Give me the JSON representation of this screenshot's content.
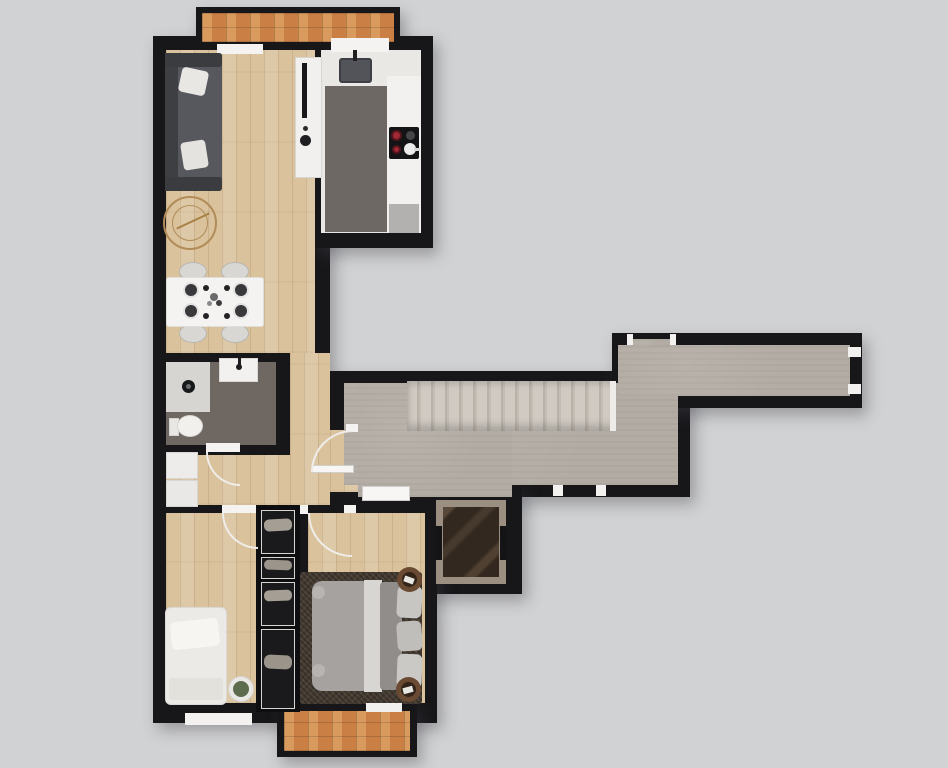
{
  "meta": {
    "label": "apartment-floor-plan",
    "canvas_width": 948,
    "canvas_height": 768
  },
  "palette": {
    "background": "#d1d2d3",
    "walls": "#17171a",
    "wood_floor": "#d9c29c",
    "stone_floor": "#b3aca4",
    "balcony_tile": "#ca8044",
    "white_fixture": "#f2f1ef",
    "kitchen_rug": "#6d6864",
    "bathroom_floor": "#6f6761",
    "bedroom_rug": "#473d33",
    "sofa": "#56585d",
    "burner_accent": "#a12834",
    "elevator_marble": "#32281f"
  },
  "shapes": [
    {
      "n": "balcony-top-frame",
      "c": "blk",
      "x": 196,
      "y": 7,
      "w": 204,
      "h": 40
    },
    {
      "n": "wall-left-wing",
      "c": "blk",
      "x": 153,
      "y": 36,
      "w": 177,
      "h": 687
    },
    {
      "n": "wall-kitchen-wing",
      "c": "blk",
      "x": 313,
      "y": 36,
      "w": 120,
      "h": 212
    },
    {
      "n": "wall-corridor-lower",
      "c": "blk",
      "x": 330,
      "y": 371,
      "w": 360,
      "h": 126
    },
    {
      "n": "wall-corridor-upper",
      "c": "blk",
      "x": 612,
      "y": 333,
      "w": 250,
      "h": 75
    },
    {
      "n": "wall-elevator",
      "c": "blk",
      "x": 420,
      "y": 486,
      "w": 102,
      "h": 108
    },
    {
      "n": "wall-bedrooms-wing",
      "c": "blk",
      "x": 300,
      "y": 495,
      "w": 137,
      "h": 228
    },
    {
      "n": "balcony-bottom-frame",
      "c": "blk",
      "x": 277,
      "y": 704,
      "w": 140,
      "h": 53
    },
    {
      "n": "balcony-top-floor",
      "c": "tile",
      "x": 202,
      "y": 13,
      "w": 192,
      "h": 29
    },
    {
      "n": "living-floor",
      "c": "wood",
      "x": 166,
      "y": 50,
      "w": 149,
      "h": 303
    },
    {
      "n": "hall-floor-right",
      "c": "wood",
      "x": 290,
      "y": 353,
      "w": 40,
      "h": 152
    },
    {
      "n": "hall-floor-lower",
      "c": "wood",
      "x": 166,
      "y": 455,
      "w": 124,
      "h": 50
    },
    {
      "n": "entry-doorway-floor",
      "c": "wood",
      "x": 330,
      "y": 430,
      "w": 28,
      "h": 62
    },
    {
      "n": "bathroom-floor",
      "f": "#6f6761",
      "x": 166,
      "y": 362,
      "w": 110,
      "h": 83
    },
    {
      "n": "corridor-floor-main",
      "c": "stone",
      "x": 344,
      "y": 383,
      "w": 334,
      "h": 102
    },
    {
      "n": "corridor-floor-lobby",
      "c": "stone",
      "x": 358,
      "y": 383,
      "w": 154,
      "h": 114
    },
    {
      "n": "corridor-floor-east",
      "c": "stone",
      "x": 618,
      "y": 345,
      "w": 232,
      "h": 51
    },
    {
      "n": "corridor-door-recess-floor",
      "c": "stone",
      "x": 632,
      "y": 339,
      "w": 38,
      "h": 8
    },
    {
      "n": "bedroom-left-floor",
      "c": "wood",
      "x": 166,
      "y": 513,
      "w": 92,
      "h": 190
    },
    {
      "n": "bedroom-right-floor",
      "c": "wood",
      "x": 308,
      "y": 513,
      "w": 117,
      "h": 190
    },
    {
      "n": "balcony-bottom-floor",
      "c": "tile",
      "x": 284,
      "y": 711,
      "w": 126,
      "h": 40
    },
    {
      "n": "staircase",
      "c": "stairs",
      "x": 407,
      "y": 381,
      "w": 209,
      "h": 50
    },
    {
      "n": "staircase-top-tread",
      "f": "#edece9",
      "x": 610,
      "y": 381,
      "w": 6,
      "h": 50
    },
    {
      "n": "kitchen-floor",
      "f": "#e9e8e5",
      "x": 321,
      "y": 50,
      "w": 100,
      "h": 183
    },
    {
      "n": "kitchen-window-sill",
      "f": "#f4f3f1",
      "x": 331,
      "y": 38,
      "w": 58,
      "h": 14
    },
    {
      "n": "living-window-sill",
      "f": "#f4f3f1",
      "x": 217,
      "y": 44,
      "w": 46,
      "h": 10
    },
    {
      "n": "kitchen-island",
      "f": "#f1f0ee",
      "bd": "1px solid #d8d6d2",
      "x": 295,
      "y": 57,
      "w": 27,
      "h": 121
    },
    {
      "n": "tv-unit",
      "f": "#18181b",
      "x": 302,
      "y": 63,
      "w": 5,
      "h": 55
    },
    {
      "n": "island-decor-small",
      "f": "#2b2b2e",
      "br": "50%",
      "x": 303,
      "y": 126,
      "w": 5,
      "h": 5
    },
    {
      "n": "island-decor-bowl",
      "f": "#1f1f22",
      "br": "50%",
      "x": 300,
      "y": 135,
      "w": 11,
      "h": 11
    },
    {
      "n": "kitchen-rug",
      "f": "#6d6864",
      "x": 325,
      "y": 86,
      "w": 62,
      "h": 146
    },
    {
      "n": "kitchen-counter-right",
      "f": "#f2f1ef",
      "x": 387,
      "y": 76,
      "w": 34,
      "h": 157
    },
    {
      "n": "kitchen-sink",
      "f": "#53545a",
      "bd": "2px solid #3e3f44",
      "br": "3px",
      "x": 339,
      "y": 58,
      "w": 33,
      "h": 25
    },
    {
      "n": "kitchen-faucet",
      "f": "#202022",
      "x": 353,
      "y": 50,
      "w": 4,
      "h": 11
    },
    {
      "n": "cooktop",
      "f": "#141416",
      "br": "2px",
      "x": 389,
      "y": 127,
      "w": 30,
      "h": 32
    },
    {
      "n": "burner-large",
      "f": "#a12834",
      "bd": "2px solid #55141c",
      "br": "50%",
      "x": 391,
      "y": 130,
      "w": 11,
      "h": 11
    },
    {
      "n": "burner-gray",
      "f": "#46464a",
      "br": "50%",
      "x": 406,
      "y": 131,
      "w": 9,
      "h": 9
    },
    {
      "n": "burner-small",
      "f": "#a12834",
      "bd": "2px solid #55141c",
      "br": "50%",
      "x": 392,
      "y": 145,
      "w": 9,
      "h": 9
    },
    {
      "n": "pan",
      "f": "#ececec",
      "br": "50%",
      "x": 404,
      "y": 143,
      "w": 12,
      "h": 12
    },
    {
      "n": "pan-handle",
      "f": "#d8d8d8",
      "x": 414,
      "y": 148,
      "w": 6,
      "h": 3
    },
    {
      "n": "kitchen-end-unit",
      "f": "#b2b1af",
      "x": 389,
      "y": 204,
      "w": 30,
      "h": 29
    },
    {
      "n": "sofa-base",
      "f": "#45474b",
      "br": "3px",
      "x": 165,
      "y": 53,
      "w": 57,
      "h": 138
    },
    {
      "n": "sofa-back",
      "f": "#3d3f43",
      "x": 165,
      "y": 53,
      "w": 13,
      "h": 138
    },
    {
      "n": "sofa-seat",
      "f": "#56585d",
      "x": 178,
      "y": 64,
      "w": 44,
      "h": 116
    },
    {
      "n": "sofa-armrest-top",
      "f": "#3a3c40",
      "br": "3px",
      "x": 165,
      "y": 53,
      "w": 57,
      "h": 14
    },
    {
      "n": "sofa-armrest-bottom",
      "f": "#3a3c40",
      "br": "3px",
      "x": 165,
      "y": 177,
      "w": 57,
      "h": 14
    },
    {
      "n": "sofa-pillow-1",
      "f": "#e9e7e3",
      "br": "4px",
      "rot": 12,
      "x": 180,
      "y": 69,
      "w": 27,
      "h": 25
    },
    {
      "n": "sofa-pillow-2",
      "f": "#e5e3df",
      "br": "4px",
      "rot": -9,
      "x": 182,
      "y": 141,
      "w": 25,
      "h": 28
    },
    {
      "n": "round-rug-outer",
      "bd": "2px solid #b18c58",
      "br": "50%",
      "x": 163,
      "y": 196,
      "w": 54,
      "h": 54
    },
    {
      "n": "round-rug-inner",
      "bd": "1px solid #b18c58",
      "br": "50%",
      "x": 172,
      "y": 205,
      "w": 36,
      "h": 36
    },
    {
      "n": "rug-sprig",
      "f": "#a98045",
      "rot": -25,
      "x": 175,
      "y": 220,
      "w": 36,
      "h": 2
    },
    {
      "n": "dining-chair-1",
      "f": "#d9d7d3",
      "bd": "1px solid #b8b6b2",
      "br": "50%",
      "x": 179,
      "y": 262,
      "w": 28,
      "h": 19
    },
    {
      "n": "dining-chair-2",
      "f": "#d9d7d3",
      "bd": "1px solid #b8b6b2",
      "br": "50%",
      "x": 221,
      "y": 262,
      "w": 28,
      "h": 19
    },
    {
      "n": "dining-chair-3",
      "f": "#d9d7d3",
      "bd": "1px solid #b8b6b2",
      "br": "50%",
      "x": 179,
      "y": 324,
      "w": 28,
      "h": 19
    },
    {
      "n": "dining-chair-4",
      "f": "#d9d7d3",
      "bd": "1px solid #b8b6b2",
      "br": "50%",
      "x": 221,
      "y": 324,
      "w": 28,
      "h": 19
    },
    {
      "n": "dining-table",
      "f": "#f4f3f1",
      "bd": "1px solid #e0dedb",
      "br": "3px",
      "x": 166,
      "y": 277,
      "w": 98,
      "h": 50
    },
    {
      "n": "plate-1",
      "f": "#39393c",
      "bd": "2px solid #e4e3e1",
      "br": "50%",
      "x": 183,
      "y": 282,
      "w": 16,
      "h": 16
    },
    {
      "n": "plate-2",
      "f": "#39393c",
      "bd": "2px solid #e4e3e1",
      "br": "50%",
      "x": 183,
      "y": 303,
      "w": 16,
      "h": 16
    },
    {
      "n": "plate-3",
      "f": "#39393c",
      "bd": "2px solid #e4e3e1",
      "br": "50%",
      "x": 233,
      "y": 282,
      "w": 16,
      "h": 16
    },
    {
      "n": "plate-4",
      "f": "#39393c",
      "bd": "2px solid #e4e3e1",
      "br": "50%",
      "x": 233,
      "y": 303,
      "w": 16,
      "h": 16
    },
    {
      "n": "cup-1",
      "f": "#232325",
      "br": "50%",
      "x": 203,
      "y": 285,
      "w": 6,
      "h": 6
    },
    {
      "n": "cup-2",
      "f": "#232325",
      "br": "50%",
      "x": 203,
      "y": 313,
      "w": 6,
      "h": 6
    },
    {
      "n": "cup-3",
      "f": "#232325",
      "br": "50%",
      "x": 224,
      "y": 285,
      "w": 6,
      "h": 6
    },
    {
      "n": "cup-4",
      "f": "#232325",
      "br": "50%",
      "x": 224,
      "y": 313,
      "w": 6,
      "h": 6
    },
    {
      "n": "centerpiece-1",
      "f": "#6b6b6e",
      "br": "50%",
      "x": 210,
      "y": 293,
      "w": 8,
      "h": 8
    },
    {
      "n": "centerpiece-2",
      "f": "#3d3d40",
      "br": "50%",
      "x": 216,
      "y": 300,
      "w": 6,
      "h": 6
    },
    {
      "n": "centerpiece-3",
      "f": "#8a8a8d",
      "br": "50%",
      "x": 207,
      "y": 301,
      "w": 5,
      "h": 5
    },
    {
      "n": "shower-tray",
      "f": "#d7d5d2",
      "x": 166,
      "y": 362,
      "w": 44,
      "h": 50
    },
    {
      "n": "shower-drain",
      "f": "#17181a",
      "br": "50%",
      "x": 182,
      "y": 380,
      "w": 13,
      "h": 13
    },
    {
      "n": "shower-drain-cap",
      "f": "#6a6a6e",
      "br": "50%",
      "x": 186,
      "y": 384,
      "w": 5,
      "h": 5
    },
    {
      "n": "bathroom-vanity",
      "f": "#f2f1ef",
      "bd": "1px solid #dbd9d6",
      "x": 219,
      "y": 358,
      "w": 39,
      "h": 24
    },
    {
      "n": "vanity-faucet",
      "f": "#1d1d1f",
      "br": "50%",
      "x": 236,
      "y": 364,
      "w": 6,
      "h": 6
    },
    {
      "n": "vanity-faucet-stem",
      "f": "#1d1d1f",
      "x": 238,
      "y": 358,
      "w": 3,
      "h": 7
    },
    {
      "n": "toilet-tank",
      "f": "#e9e7e4",
      "bd": "1px solid #d5d3d0",
      "x": 169,
      "y": 418,
      "w": 10,
      "h": 18
    },
    {
      "n": "toilet-bowl",
      "f": "#f2f0ed",
      "bd": "1px solid #d8d6d2",
      "br": "50%",
      "x": 177,
      "y": 415,
      "w": 26,
      "h": 22
    },
    {
      "n": "bathroom-door-threshold",
      "f": "#f4f3f1",
      "x": 206,
      "y": 443,
      "w": 34,
      "h": 9
    },
    {
      "n": "bathroom-door-arc",
      "corner": "bl",
      "f": "#efede9",
      "x": 206,
      "y": 452,
      "w": 34,
      "h": 34
    },
    {
      "n": "laundry-cabinet-1",
      "f": "#edecea",
      "bd": "1px solid #d8d6d3",
      "x": 166,
      "y": 452,
      "w": 32,
      "h": 27
    },
    {
      "n": "laundry-cabinet-2",
      "f": "#e9e8e6",
      "bd": "1px solid #d8d6d3",
      "x": 166,
      "y": 480,
      "w": 32,
      "h": 27
    },
    {
      "n": "entry-door-jamb",
      "f": "#f4f3f1",
      "x": 346,
      "y": 424,
      "w": 12,
      "h": 8
    },
    {
      "n": "entry-door-leaf",
      "f": "#f7f6f4",
      "bd": "1px solid #d0cecb",
      "x": 312,
      "y": 465,
      "w": 42,
      "h": 8
    },
    {
      "n": "entry-door-arc",
      "corner": "tl",
      "f": "#efede9",
      "x": 311,
      "y": 430,
      "w": 42,
      "h": 42
    },
    {
      "n": "lobby-door",
      "f": "#f7f6f4",
      "bd": "1px solid #cfcdc9",
      "x": 362,
      "y": 486,
      "w": 48,
      "h": 15
    },
    {
      "n": "elevator-frame",
      "f": "#9a8f80",
      "x": 436,
      "y": 500,
      "w": 70,
      "h": 84
    },
    {
      "n": "elevator-cab",
      "c": "marble",
      "x": 443,
      "y": 507,
      "w": 56,
      "h": 70
    },
    {
      "n": "elevator-door-left",
      "f": "#141416",
      "x": 436,
      "y": 526,
      "w": 6,
      "h": 34
    },
    {
      "n": "elevator-door-right",
      "f": "#141416",
      "x": 500,
      "y": 526,
      "w": 6,
      "h": 34
    },
    {
      "n": "unit-door-jamb-a",
      "f": "#f2f1ef",
      "x": 627,
      "y": 334,
      "w": 6,
      "h": 11
    },
    {
      "n": "unit-door-jamb-b",
      "f": "#f2f1ef",
      "x": 670,
      "y": 334,
      "w": 6,
      "h": 11
    },
    {
      "n": "east-door-jamb-a",
      "f": "#f2f1ef",
      "x": 848,
      "y": 347,
      "w": 13,
      "h": 10
    },
    {
      "n": "east-door-jamb-b",
      "f": "#f2f1ef",
      "x": 848,
      "y": 384,
      "w": 13,
      "h": 10
    },
    {
      "n": "south-door-jamb-a",
      "f": "#f2f1ef",
      "x": 553,
      "y": 485,
      "w": 10,
      "h": 11
    },
    {
      "n": "south-door-jamb-b",
      "f": "#f2f1ef",
      "x": 596,
      "y": 485,
      "w": 10,
      "h": 11
    },
    {
      "n": "wardrobe-column",
      "f": "#0e0e10",
      "x": 256,
      "y": 505,
      "w": 44,
      "h": 207
    },
    {
      "n": "wardrobe-section-1",
      "f": "#1a1a1d",
      "bd": "1px solid #d6d5d2",
      "x": 261,
      "y": 510,
      "w": 34,
      "h": 44
    },
    {
      "n": "wardrobe-section-2",
      "f": "#1a1a1d",
      "bd": "1px solid #d6d5d2",
      "x": 261,
      "y": 557,
      "w": 34,
      "h": 22
    },
    {
      "n": "wardrobe-section-3",
      "f": "#1a1a1d",
      "bd": "1px solid #d6d5d2",
      "x": 261,
      "y": 582,
      "w": 34,
      "h": 44
    },
    {
      "n": "wardrobe-section-4",
      "f": "#1a1a1d",
      "bd": "1px solid #d6d5d2",
      "x": 261,
      "y": 629,
      "w": 34,
      "h": 80
    },
    {
      "n": "wardrobe-clothes-1",
      "f": "#a59e94",
      "br": "5px",
      "rot": -3,
      "x": 264,
      "y": 519,
      "w": 28,
      "h": 12
    },
    {
      "n": "wardrobe-clothes-2",
      "f": "#9b948b",
      "br": "5px",
      "rot": 2,
      "x": 264,
      "y": 560,
      "w": 28,
      "h": 10
    },
    {
      "n": "wardrobe-clothes-3",
      "f": "#a59e94",
      "br": "5px",
      "rot": -2,
      "x": 264,
      "y": 590,
      "w": 28,
      "h": 11
    },
    {
      "n": "wardrobe-clothes-4",
      "f": "#9b948b",
      "br": "6px",
      "rot": 3,
      "x": 264,
      "y": 655,
      "w": 28,
      "h": 14
    },
    {
      "n": "bedroom-left-door-threshold",
      "f": "#f4f3f1",
      "x": 222,
      "y": 505,
      "w": 34,
      "h": 8
    },
    {
      "n": "bedroom-left-door-arc",
      "corner": "bl",
      "f": "#efede9",
      "x": 222,
      "y": 513,
      "w": 36,
      "h": 36
    },
    {
      "n": "bedroom-right-door-jamb",
      "f": "#f4f3f1",
      "x": 300,
      "y": 505,
      "w": 8,
      "h": 9
    },
    {
      "n": "bedroom-right-door-jamb-b",
      "f": "#f4f3f1",
      "x": 344,
      "y": 505,
      "w": 12,
      "h": 8
    },
    {
      "n": "bedroom-right-door-arc",
      "corner": "bl",
      "f": "#efede9",
      "x": 308,
      "y": 513,
      "w": 44,
      "h": 44
    },
    {
      "n": "single-bed",
      "f": "#eceae7",
      "bd": "1px solid #dbd9d5",
      "br": "6px",
      "x": 165,
      "y": 607,
      "w": 62,
      "h": 98
    },
    {
      "n": "single-bed-pillow",
      "f": "#f6f5f2",
      "br": "5px",
      "rot": -6,
      "x": 171,
      "y": 620,
      "w": 48,
      "h": 28
    },
    {
      "n": "single-bed-blanket",
      "f": "#e3e1dc",
      "br": "3px",
      "x": 169,
      "y": 678,
      "w": 54,
      "h": 22
    },
    {
      "n": "plant-pot",
      "f": "#eae8e4",
      "bd": "1px solid #d4d2ce",
      "br": "50%",
      "x": 228,
      "y": 676,
      "w": 26,
      "h": 26
    },
    {
      "n": "plant",
      "f": "#5c6c4c",
      "br": "50%",
      "x": 233,
      "y": 681,
      "w": 16,
      "h": 16
    },
    {
      "n": "bedroom-rug",
      "c": "shag",
      "br": "3px",
      "x": 300,
      "y": 572,
      "w": 122,
      "h": 132
    },
    {
      "n": "double-bed-duvet",
      "f": "#a5a2a0",
      "br": "10px",
      "x": 312,
      "y": 581,
      "w": 60,
      "h": 110
    },
    {
      "n": "double-bed-sheet",
      "f": "#d8d6d2",
      "x": 364,
      "y": 580,
      "w": 18,
      "h": 112
    },
    {
      "n": "double-bed-duvet-2",
      "f": "#908d8a",
      "br": "4px",
      "x": 380,
      "y": 582,
      "w": 22,
      "h": 108
    },
    {
      "n": "bed-pillow-1",
      "f": "#c8c6c3",
      "br": "6px",
      "rot": 3,
      "x": 397,
      "y": 586,
      "w": 25,
      "h": 32
    },
    {
      "n": "bed-pillow-2",
      "f": "#c0beba",
      "br": "6px",
      "rot": -4,
      "x": 397,
      "y": 621,
      "w": 25,
      "h": 30
    },
    {
      "n": "bed-pillow-3",
      "f": "#cbc9c6",
      "br": "6px",
      "rot": 2,
      "x": 397,
      "y": 654,
      "w": 25,
      "h": 34
    },
    {
      "n": "bed-cushion-1",
      "f": "#b7b4b1",
      "br": "50%",
      "x": 312,
      "y": 586,
      "w": 13,
      "h": 13
    },
    {
      "n": "bed-cushion-2",
      "f": "#b7b4b1",
      "br": "50%",
      "x": 312,
      "y": 664,
      "w": 13,
      "h": 13
    },
    {
      "n": "nightstand-top",
      "f": "#6b4a33",
      "br": "50%",
      "x": 397,
      "y": 567,
      "w": 25,
      "h": 25
    },
    {
      "n": "nightstand-top-tray",
      "f": "#33241a",
      "br": "50%",
      "x": 402,
      "y": 572,
      "w": 15,
      "h": 15
    },
    {
      "n": "nightstand-top-napkin",
      "f": "#e8e6e2",
      "rot": 20,
      "x": 404,
      "y": 577,
      "w": 10,
      "h": 6
    },
    {
      "n": "nightstand-bottom",
      "f": "#6b4a33",
      "br": "50%",
      "x": 396,
      "y": 677,
      "w": 25,
      "h": 25
    },
    {
      "n": "nightstand-bottom-tray",
      "f": "#33241a",
      "br": "50%",
      "x": 401,
      "y": 682,
      "w": 15,
      "h": 15
    },
    {
      "n": "nightstand-bottom-napkin",
      "f": "#e8e6e2",
      "rot": -15,
      "x": 403,
      "y": 687,
      "w": 10,
      "h": 6
    },
    {
      "n": "bedroom-left-window-sill",
      "f": "#f3f2f0",
      "x": 185,
      "y": 713,
      "w": 67,
      "h": 12
    },
    {
      "n": "balcony-door-threshold",
      "f": "#f1f0ee",
      "x": 366,
      "y": 703,
      "w": 36,
      "h": 9
    }
  ]
}
